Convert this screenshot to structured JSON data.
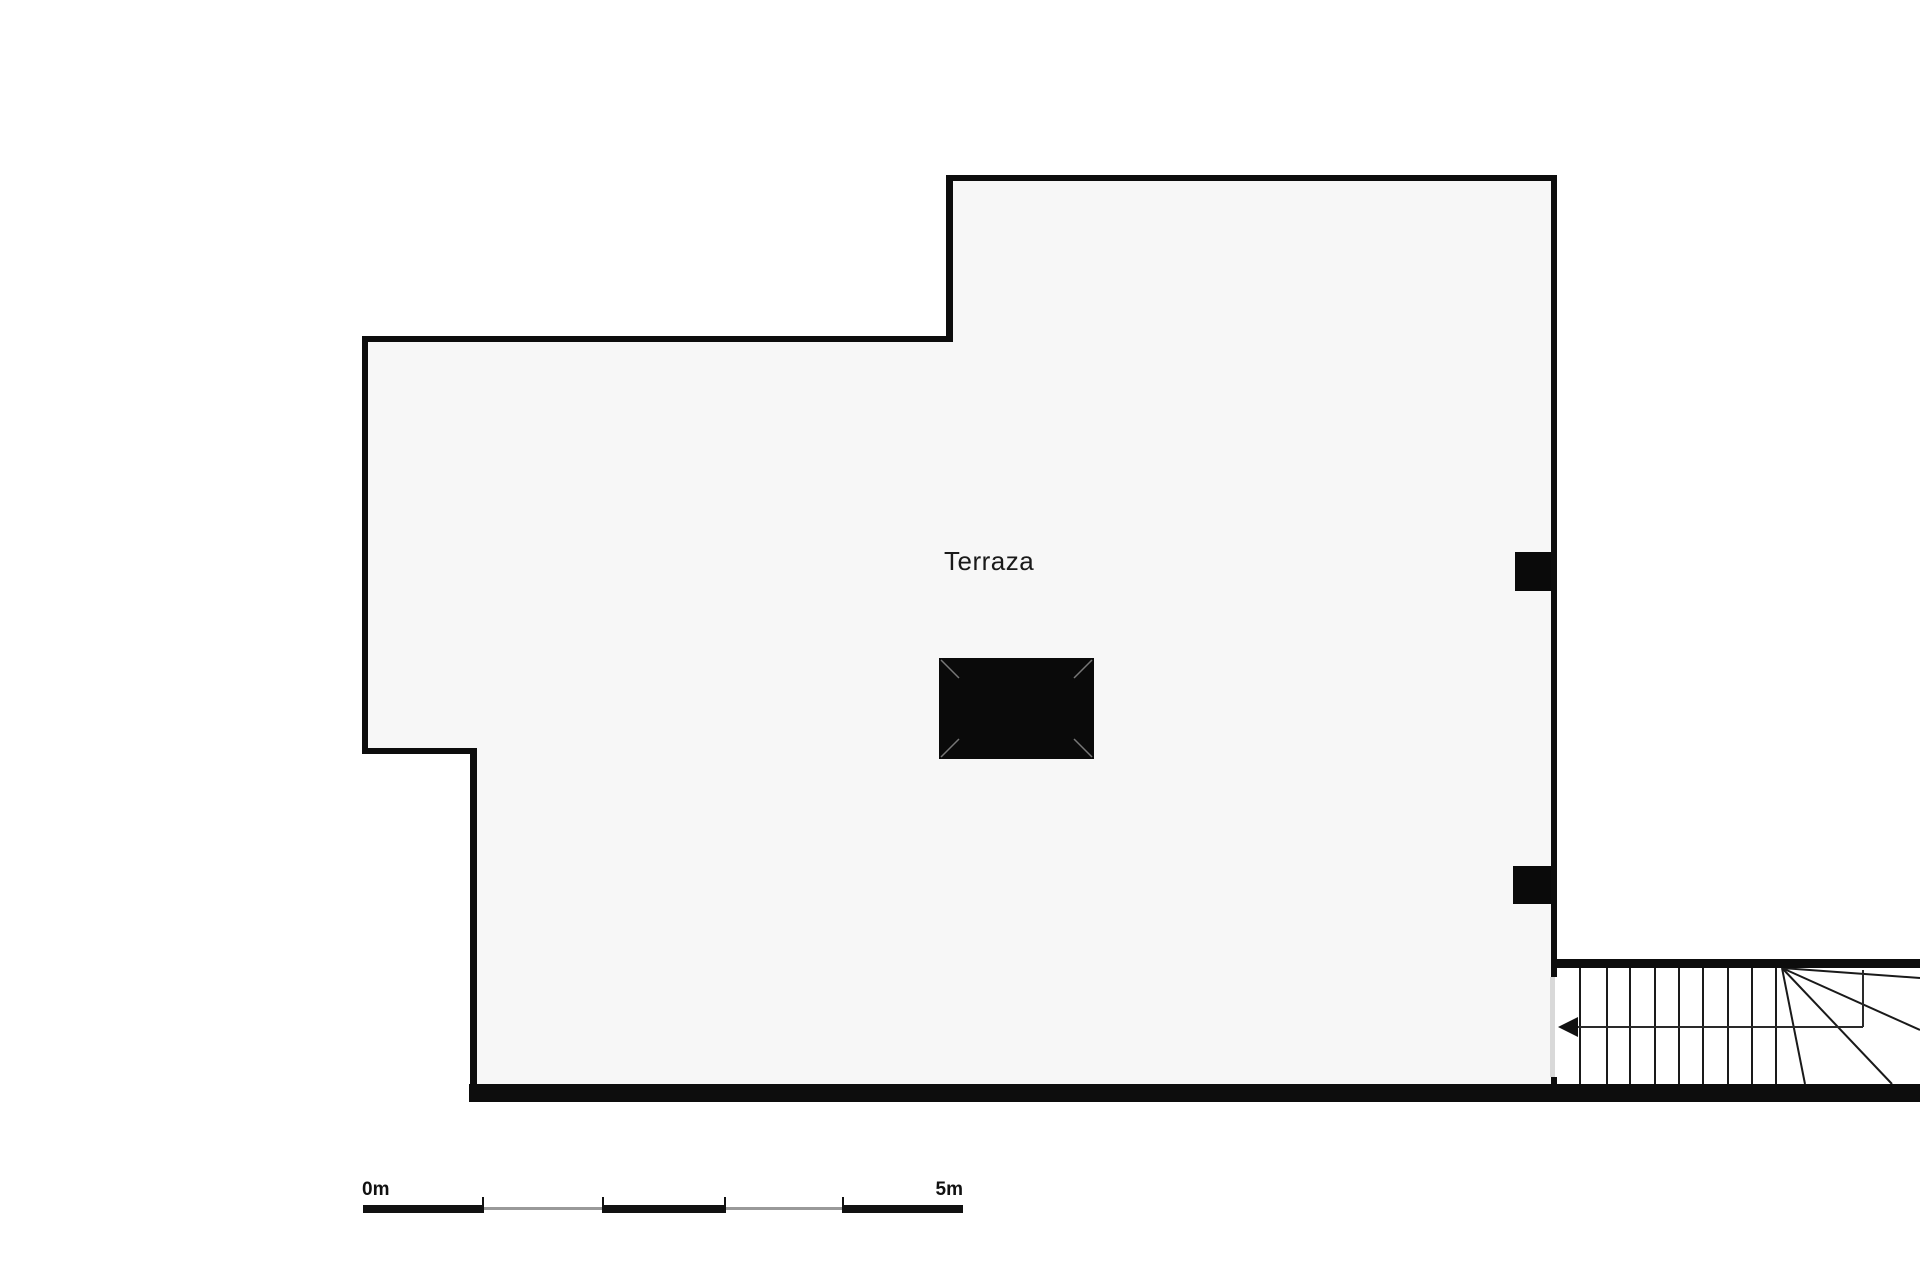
{
  "room": {
    "label": "Terraza"
  },
  "scale_bar": {
    "start_label": "0m",
    "end_label": "5m",
    "meters_total": 5,
    "pixels_per_meter": 120
  },
  "colors": {
    "wall": "#0d0d0d",
    "floor": "#f7f7f7",
    "background": "#ffffff",
    "stair_line": "#1a1a1a",
    "walking_line": "#2a2a2a",
    "opening": "#d9d9d9",
    "scale_black": "#111111",
    "scale_gray": "#999999",
    "table_fill": "#0a0a0a",
    "table_miter": "#777777"
  },
  "floor_plan": {
    "canvas": {
      "width": 1920,
      "height": 1280
    },
    "shapes": [
      {
        "type": "polygon",
        "name": "terrace-floor",
        "points": "365,339 950,339 950,178 1554,178 1554,1090 473,1090 473,751 365,751",
        "fill": "#f7f7f7"
      },
      {
        "type": "rect",
        "name": "table-rect",
        "x": 939,
        "y": 658,
        "w": 155,
        "h": 101,
        "fill": "#0a0a0a"
      },
      {
        "type": "line",
        "name": "table-miter-tl",
        "x1": 941,
        "y1": 660,
        "x2": 959,
        "y2": 678,
        "stroke": "#777777",
        "sw": 1.5
      },
      {
        "type": "line",
        "name": "table-miter-tr",
        "x1": 1092,
        "y1": 660,
        "x2": 1074,
        "y2": 678,
        "stroke": "#777777",
        "sw": 1.5
      },
      {
        "type": "line",
        "name": "table-miter-bl",
        "x1": 941,
        "y1": 757,
        "x2": 959,
        "y2": 739,
        "stroke": "#777777",
        "sw": 1.5
      },
      {
        "type": "line",
        "name": "table-miter-br",
        "x1": 1092,
        "y1": 757,
        "x2": 1074,
        "y2": 739,
        "stroke": "#777777",
        "sw": 1.5
      },
      {
        "type": "rect",
        "name": "wall-pillar-upper",
        "x": 1515,
        "y": 552,
        "w": 39,
        "h": 39,
        "fill": "#0a0a0a"
      },
      {
        "type": "rect",
        "name": "wall-pillar-lower",
        "x": 1513,
        "y": 866,
        "w": 41,
        "h": 38,
        "fill": "#0a0a0a"
      },
      {
        "type": "line",
        "name": "stair-tread-line",
        "x1": 1580,
        "y1": 968,
        "x2": 1580,
        "y2": 1084,
        "stroke": "#1a1a1a",
        "sw": 2
      },
      {
        "type": "line",
        "name": "stair-tread-line",
        "x1": 1607,
        "y1": 968,
        "x2": 1607,
        "y2": 1084,
        "stroke": "#1a1a1a",
        "sw": 2
      },
      {
        "type": "line",
        "name": "stair-tread-line",
        "x1": 1630,
        "y1": 968,
        "x2": 1630,
        "y2": 1084,
        "stroke": "#1a1a1a",
        "sw": 2
      },
      {
        "type": "line",
        "name": "stair-tread-line",
        "x1": 1655,
        "y1": 968,
        "x2": 1655,
        "y2": 1084,
        "stroke": "#1a1a1a",
        "sw": 2
      },
      {
        "type": "line",
        "name": "stair-tread-line",
        "x1": 1679,
        "y1": 968,
        "x2": 1679,
        "y2": 1084,
        "stroke": "#1a1a1a",
        "sw": 2
      },
      {
        "type": "line",
        "name": "stair-tread-line",
        "x1": 1703,
        "y1": 968,
        "x2": 1703,
        "y2": 1084,
        "stroke": "#1a1a1a",
        "sw": 2
      },
      {
        "type": "line",
        "name": "stair-tread-line",
        "x1": 1728,
        "y1": 968,
        "x2": 1728,
        "y2": 1084,
        "stroke": "#1a1a1a",
        "sw": 2
      },
      {
        "type": "line",
        "name": "stair-tread-line",
        "x1": 1752,
        "y1": 968,
        "x2": 1752,
        "y2": 1084,
        "stroke": "#1a1a1a",
        "sw": 2
      },
      {
        "type": "line",
        "name": "stair-tread-line",
        "x1": 1776,
        "y1": 968,
        "x2": 1776,
        "y2": 1084,
        "stroke": "#1a1a1a",
        "sw": 2
      },
      {
        "type": "line",
        "name": "stair-winder-line",
        "x1": 1782,
        "y1": 968,
        "x2": 1920,
        "y2": 978,
        "stroke": "#1a1a1a",
        "sw": 2
      },
      {
        "type": "line",
        "name": "stair-winder-line",
        "x1": 1782,
        "y1": 968,
        "x2": 1920,
        "y2": 1030,
        "stroke": "#1a1a1a",
        "sw": 2
      },
      {
        "type": "line",
        "name": "stair-winder-line",
        "x1": 1782,
        "y1": 968,
        "x2": 1892,
        "y2": 1084,
        "stroke": "#1a1a1a",
        "sw": 2
      },
      {
        "type": "line",
        "name": "stair-winder-line",
        "x1": 1782,
        "y1": 968,
        "x2": 1805,
        "y2": 1084,
        "stroke": "#1a1a1a",
        "sw": 2
      },
      {
        "type": "line",
        "name": "stair-walking-line-h",
        "x1": 1578,
        "y1": 1027,
        "x2": 1863,
        "y2": 1027,
        "stroke": "#2a2a2a",
        "sw": 2
      },
      {
        "type": "line",
        "name": "stair-walking-line-v",
        "x1": 1863,
        "y1": 1027,
        "x2": 1863,
        "y2": 970,
        "stroke": "#2a2a2a",
        "sw": 2
      },
      {
        "type": "polygon",
        "name": "stair-walking-arrow",
        "points": "1558,1027 1578,1017 1578,1037",
        "fill": "#111111"
      },
      {
        "type": "rect",
        "name": "wall-top-left-edge",
        "x": 362,
        "y": 336,
        "w": 591,
        "h": 6,
        "fill": "#0d0d0d"
      },
      {
        "type": "rect",
        "name": "wall-step-vertical",
        "x": 946,
        "y": 175,
        "w": 7,
        "h": 167,
        "fill": "#0d0d0d"
      },
      {
        "type": "rect",
        "name": "wall-top-right-edge",
        "x": 946,
        "y": 175,
        "w": 611,
        "h": 6,
        "fill": "#0d0d0d"
      },
      {
        "type": "rect",
        "name": "wall-right",
        "x": 1551,
        "y": 175,
        "w": 6,
        "h": 802,
        "fill": "#0d0d0d"
      },
      {
        "type": "rect",
        "name": "wall-right-stub",
        "x": 1551,
        "y": 1077,
        "w": 6,
        "h": 25,
        "fill": "#0d0d0d"
      },
      {
        "type": "rect",
        "name": "wall-bottom",
        "x": 469,
        "y": 1084,
        "w": 1451,
        "h": 18,
        "fill": "#0d0d0d"
      },
      {
        "type": "rect",
        "name": "wall-notch-vertical",
        "x": 470,
        "y": 748,
        "w": 7,
        "h": 354,
        "fill": "#0d0d0d"
      },
      {
        "type": "rect",
        "name": "wall-notch-horizontal",
        "x": 362,
        "y": 748,
        "w": 115,
        "h": 6,
        "fill": "#0d0d0d"
      },
      {
        "type": "rect",
        "name": "wall-left",
        "x": 362,
        "y": 336,
        "w": 6,
        "h": 418,
        "fill": "#0d0d0d"
      },
      {
        "type": "rect",
        "name": "wall-stairs-top",
        "x": 1551,
        "y": 959,
        "w": 369,
        "h": 9,
        "fill": "#0d0d0d"
      },
      {
        "type": "rect",
        "name": "stair-opening-threshold",
        "x": 1550,
        "y": 977,
        "w": 5,
        "h": 100,
        "fill": "#d9d9d9"
      },
      {
        "type": "rect",
        "name": "scale-bar-segment-black",
        "x": 363,
        "y": 1205,
        "w": 120,
        "h": 8,
        "fill": "#111111"
      },
      {
        "type": "rect",
        "name": "scale-bar-segment-gray",
        "x": 483,
        "y": 1207,
        "w": 120,
        "h": 3,
        "fill": "#999999"
      },
      {
        "type": "rect",
        "name": "scale-bar-segment-black",
        "x": 603,
        "y": 1205,
        "w": 122,
        "h": 8,
        "fill": "#111111"
      },
      {
        "type": "rect",
        "name": "scale-bar-segment-gray",
        "x": 725,
        "y": 1207,
        "w": 118,
        "h": 3,
        "fill": "#999999"
      },
      {
        "type": "rect",
        "name": "scale-bar-segment-black",
        "x": 843,
        "y": 1205,
        "w": 120,
        "h": 8,
        "fill": "#111111"
      },
      {
        "type": "rect",
        "name": "scale-bar-tick",
        "x": 482,
        "y": 1197,
        "w": 2,
        "h": 16,
        "fill": "#111111"
      },
      {
        "type": "rect",
        "name": "scale-bar-tick",
        "x": 602,
        "y": 1197,
        "w": 2,
        "h": 16,
        "fill": "#111111"
      },
      {
        "type": "rect",
        "name": "scale-bar-tick",
        "x": 724,
        "y": 1197,
        "w": 2,
        "h": 16,
        "fill": "#111111"
      },
      {
        "type": "rect",
        "name": "scale-bar-tick",
        "x": 842,
        "y": 1197,
        "w": 2,
        "h": 16,
        "fill": "#111111"
      }
    ]
  }
}
